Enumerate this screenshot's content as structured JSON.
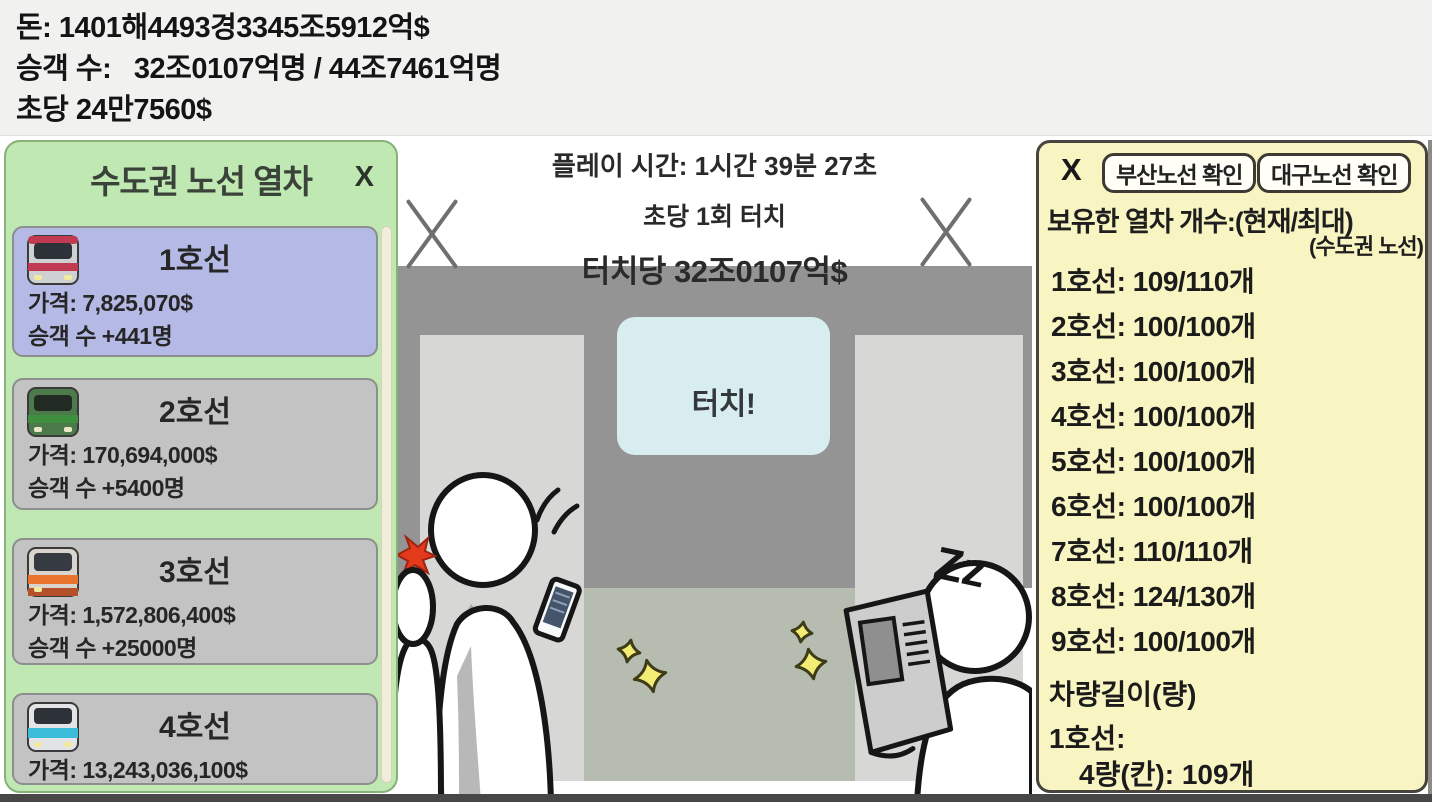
{
  "stats": {
    "money": "돈: 1401해4493경3345조5912억$",
    "passengers": "승객 수:   32조0107억명 / 44조7461억명",
    "per_second": "초당 24만7560$"
  },
  "left_panel": {
    "title": "수도권 노선 열차",
    "close_label": "X",
    "trains": [
      {
        "name": "1호선",
        "price": "가격: 7,825,070$",
        "passengers": "승객 수 +441명",
        "icon": "train-line-1",
        "selected": true
      },
      {
        "name": "2호선",
        "price": "가격: 170,694,000$",
        "passengers": "승객 수 +5400명",
        "icon": "train-line-2",
        "selected": false
      },
      {
        "name": "3호선",
        "price": "가격: 1,572,806,400$",
        "passengers": "승객 수 +25000명",
        "icon": "train-line-3",
        "selected": false
      },
      {
        "name": "4호선",
        "price": "가격: 13,243,036,100$",
        "passengers": "",
        "icon": "train-line-4",
        "selected": false
      }
    ]
  },
  "stage": {
    "play_time": "플레이 시간: 1시간 39분 27초",
    "touch_rate": "초당 1회 터치",
    "per_touch": "터치당 32조0107억$",
    "touch_button": "터치!",
    "sleep_text": "Zz"
  },
  "right_panel": {
    "close_label": "X",
    "busan_button": "부산노선 확인",
    "daegu_button": "대구노선 확인",
    "owned_title": "보유한 열차 개수:(현재/최대)",
    "owned_subtitle": "(수도권 노선)",
    "owned": [
      "1호선: 109/110개",
      "2호선: 100/100개",
      "3호선: 100/100개",
      "4호선: 100/100개",
      "5호선: 100/100개",
      "6호선: 100/100개",
      "7호선: 110/110개",
      "8호선: 124/130개",
      "9호선: 100/100개"
    ],
    "length_title": "차량길이(량)",
    "length_line": "1호선:",
    "length_value": "4량(칸): 109개"
  },
  "colors": {
    "topbar_bg": "#f1f1f0",
    "left_panel_bg": "#bfe8b3",
    "left_panel_border": "#87b07b",
    "card_selected_bg": "#b5b9e6",
    "card_bg": "#c3c3c3",
    "scrollbar": "#f2eddb",
    "wall": "#949494",
    "pillar": "#d7d7d6",
    "floor": "#b6bcb0",
    "touch_button_bg": "#d8edf0",
    "right_panel_bg": "#f9f5c2",
    "right_panel_border": "#46443c",
    "button_bg": "#fffef7",
    "sparkle": "#f4ed75",
    "alert_red": "#e33a1c",
    "line1_accent": "#c03a52",
    "line2_accent": "#3e8f3e",
    "line3_accent": "#e8742e",
    "line4_accent": "#3bbcd8"
  }
}
